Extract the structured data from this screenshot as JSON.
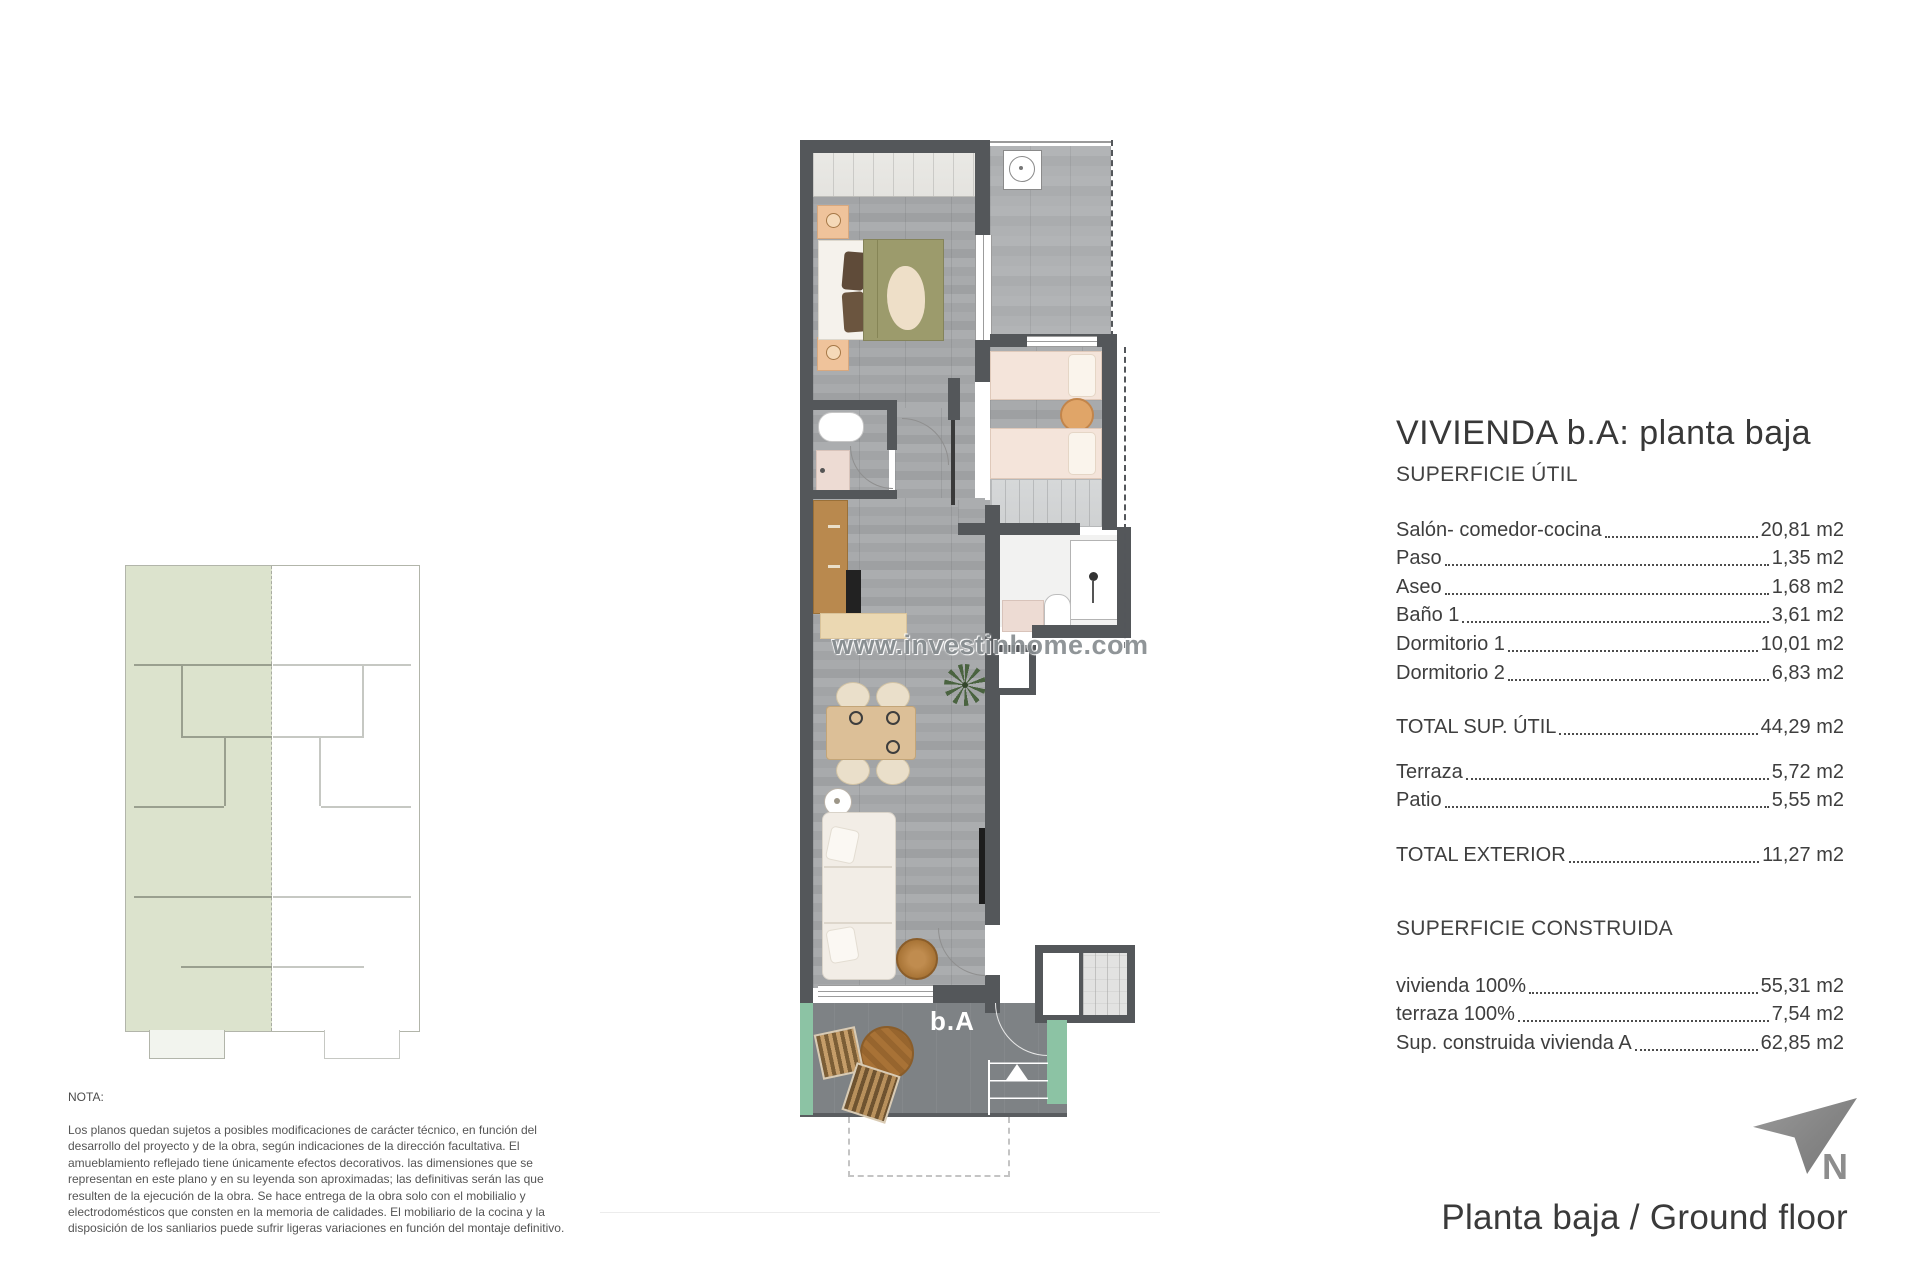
{
  "title_block": {
    "title": "VIVIENDA b.A: planta baja",
    "superficie_util": {
      "heading": "SUPERFICIE ÚTIL",
      "rows": [
        {
          "label": "Salón- comedor-cocina",
          "value": "20,81 m2"
        },
        {
          "label": "Paso",
          "value": "1,35 m2"
        },
        {
          "label": "Aseo",
          "value": "1,68 m2"
        },
        {
          "label": "Baño 1",
          "value": "3,61 m2"
        },
        {
          "label": "Dormitorio 1",
          "value": "10,01 m2"
        },
        {
          "label": "Dormitorio 2",
          "value": "6,83 m2"
        }
      ],
      "total": {
        "label": "TOTAL SUP. ÚTIL",
        "value": "44,29 m2"
      }
    },
    "exterior": {
      "rows": [
        {
          "label": "Terraza",
          "value": "5,72 m2"
        },
        {
          "label": "Patio",
          "value": "5,55 m2"
        }
      ],
      "total": {
        "label": "TOTAL EXTERIOR",
        "value": "11,27 m2"
      }
    },
    "superficie_construida": {
      "heading": "SUPERFICIE CONSTRUIDA",
      "rows": [
        {
          "label": "vivienda 100%",
          "value": "55,31 m2"
        },
        {
          "label": "terraza 100%",
          "value": "7,54 m2"
        },
        {
          "label": "Sup. construida vivienda A",
          "value": "62,85 m2"
        }
      ]
    }
  },
  "note": {
    "heading": "NOTA:",
    "body": "Los planos quedan sujetos a posibles modificaciones de carácter técnico, en función del desarrollo del proyecto y de la obra, según indicaciones de la dirección facultativa. El amueblamiento reflejado tiene únicamente efectos decorativos. las dimensiones que se representan en este plano y en su leyenda son aproximadas; las definitivas serán las que resulten de la ejecución de la obra. Se hace entrega de la obra solo con el mobilialio y electrodomésticos que consten en la memoria de calidades. El mobiliario de la cocina y la disposición de los sanliarios puede sufrir ligeras variaciones en función del montaje definitivo."
  },
  "watermark": "www.investinhome.com",
  "plan": {
    "unit_label": "b.A"
  },
  "footer": {
    "north_label": "N",
    "caption": "Planta baja / Ground floor"
  },
  "colors": {
    "wall": "#54575a",
    "floor_gray": "#a7a9ab",
    "terrace_floor": "#7e8285",
    "planter_green": "#8cc3a4",
    "mini_plan_highlight": "#dce3cd",
    "bed_olive": "#9c9b6c",
    "bed_cream": "#f4e4da",
    "wood": "#b9894e",
    "north_gray": "#8d8d8d"
  }
}
